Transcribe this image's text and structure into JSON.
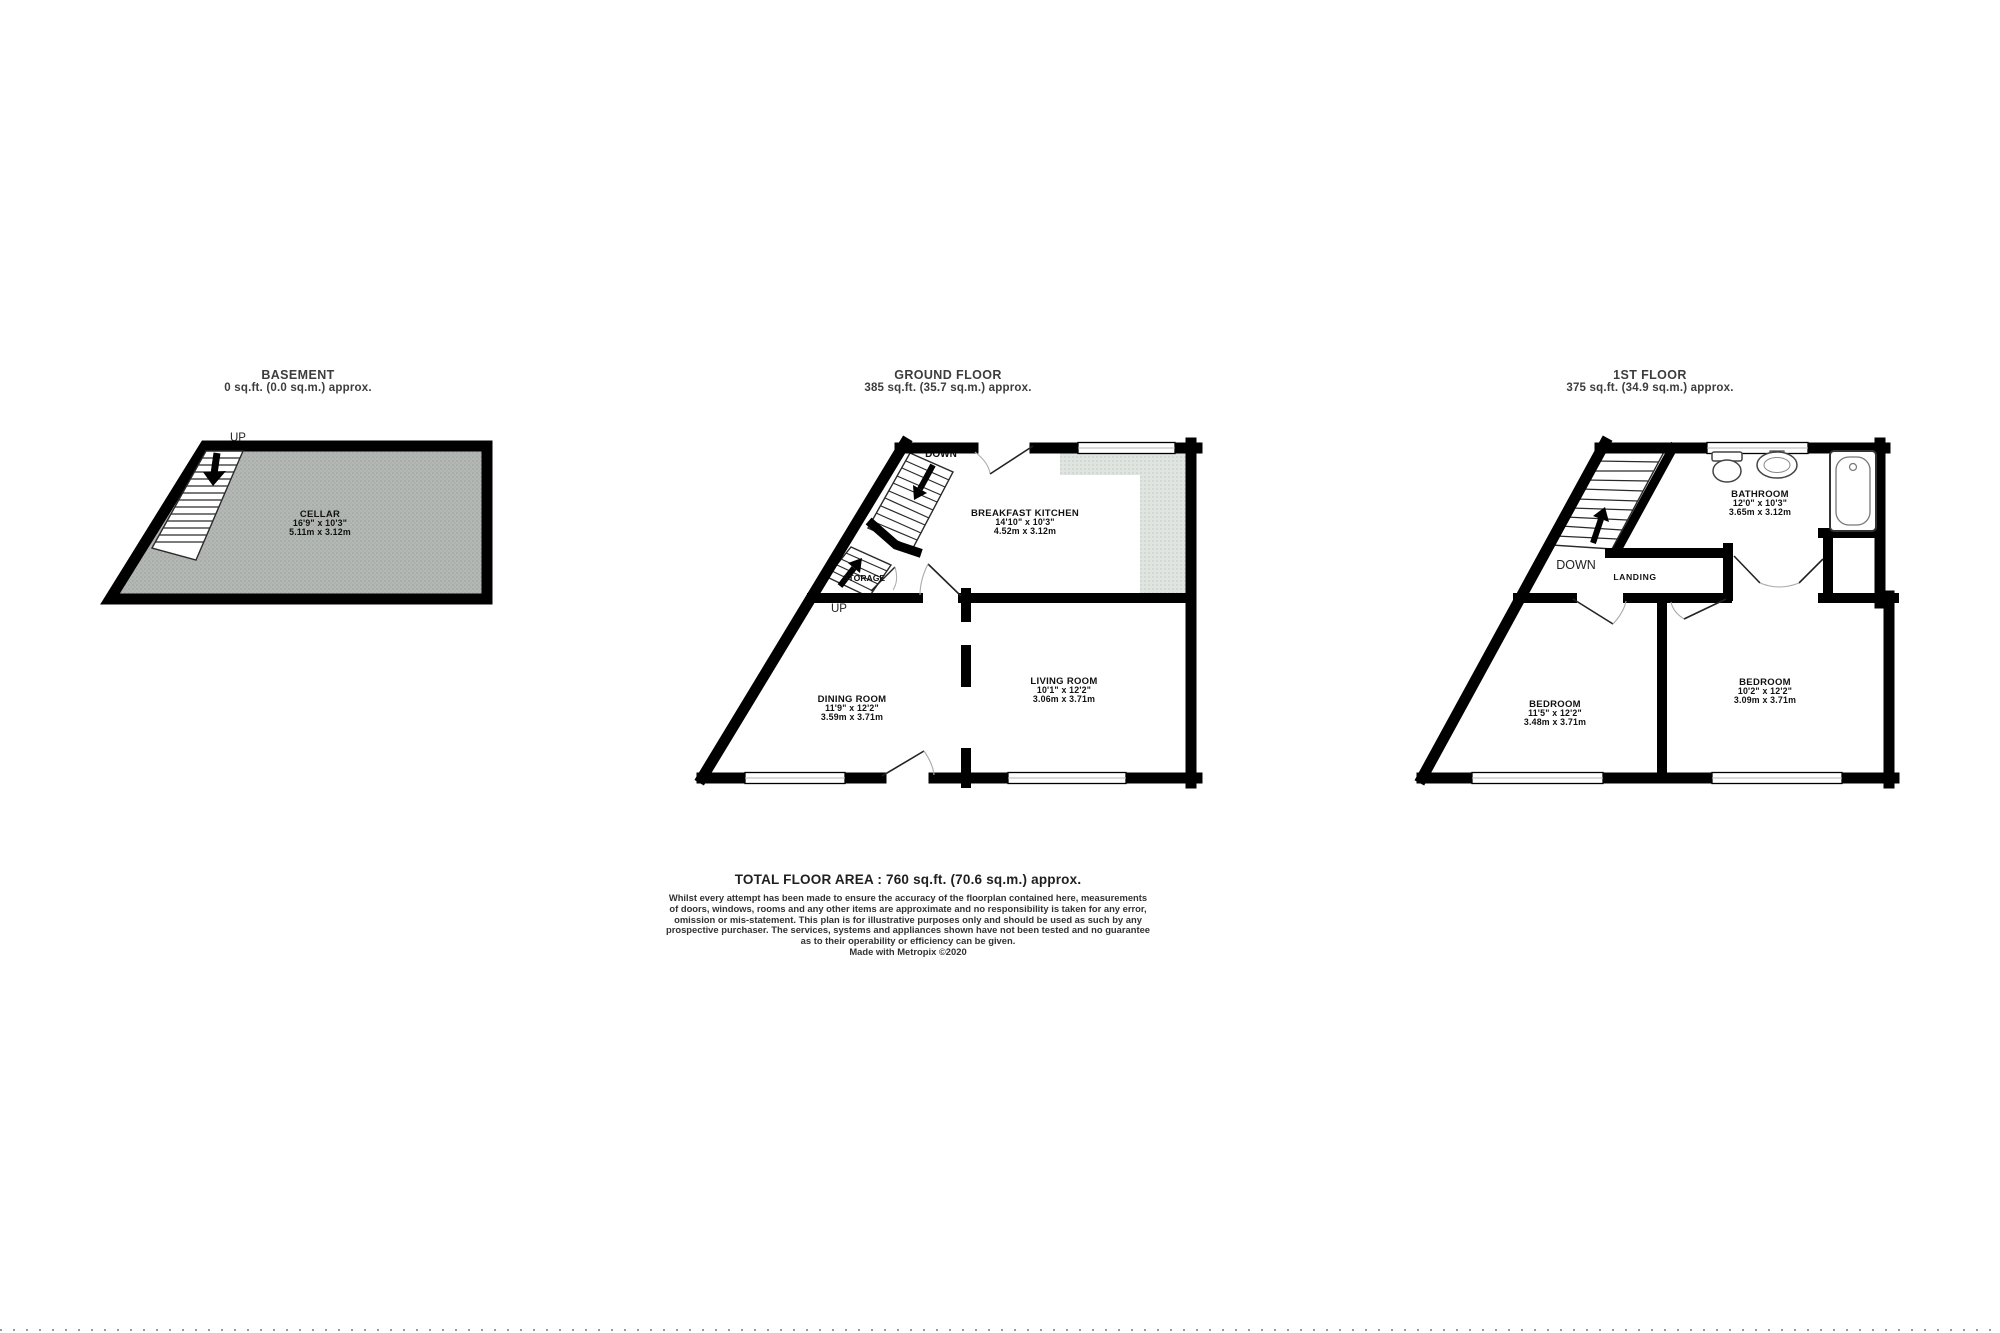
{
  "colors": {
    "wall": "#000000",
    "cellar_fill": "#b2b6b2",
    "counter_fill": "#dfe3df",
    "text": "#111111",
    "title_text": "#3d3d3d"
  },
  "floors": [
    {
      "id": "basement",
      "title": "BASEMENT",
      "area_label": "0 sq.ft. (0.0 sq.m.) approx.",
      "stairs_up_label": "UP",
      "rooms": [
        {
          "name": "CELLAR",
          "dim_imperial": "16'9\" x 10'3\"",
          "dim_metric": "5.11m x 3.12m"
        }
      ]
    },
    {
      "id": "ground-floor",
      "title": "GROUND FLOOR",
      "area_label": "385 sq.ft. (35.7 sq.m.) approx.",
      "stairs_up_label": "UP",
      "stairs_down_label": "DOWN",
      "storage_label": "STORAGE",
      "rooms": [
        {
          "name": "BREAKFAST KITCHEN",
          "dim_imperial": "14'10\" x 10'3\"",
          "dim_metric": "4.52m x 3.12m"
        },
        {
          "name": "DINING ROOM",
          "dim_imperial": "11'9\" x 12'2\"",
          "dim_metric": "3.59m x 3.71m"
        },
        {
          "name": "LIVING ROOM",
          "dim_imperial": "10'1\" x 12'2\"",
          "dim_metric": "3.06m x 3.71m"
        }
      ]
    },
    {
      "id": "first-floor",
      "title": "1ST FLOOR",
      "area_label": "375 sq.ft. (34.9 sq.m.) approx.",
      "stairs_down_label": "DOWN",
      "landing_label": "LANDING",
      "rooms": [
        {
          "name": "BATHROOM",
          "dim_imperial": "12'0\" x 10'3\"",
          "dim_metric": "3.65m x 3.12m"
        },
        {
          "name": "BEDROOM",
          "dim_imperial": "11'5\" x 12'2\"",
          "dim_metric": "3.48m x 3.71m"
        },
        {
          "name": "BEDROOM",
          "dim_imperial": "10'2\" x 12'2\"",
          "dim_metric": "3.09m x 3.71m"
        }
      ]
    }
  ],
  "footer": {
    "total": "TOTAL FLOOR AREA : 760 sq.ft. (70.6 sq.m.) approx.",
    "disclaimer_lines": [
      "Whilst every attempt has been made to ensure the accuracy of the floorplan contained here, measurements",
      "of doors, windows, rooms and any other items are approximate and no responsibility is taken for any error,",
      "omission or mis-statement. This plan is for illustrative purposes only and should be used as such by any",
      "prospective purchaser. The services, systems and appliances shown have not been tested and no guarantee",
      "as to their operability or efficiency can be given."
    ],
    "credit": "Made with Metropix ©2020"
  }
}
